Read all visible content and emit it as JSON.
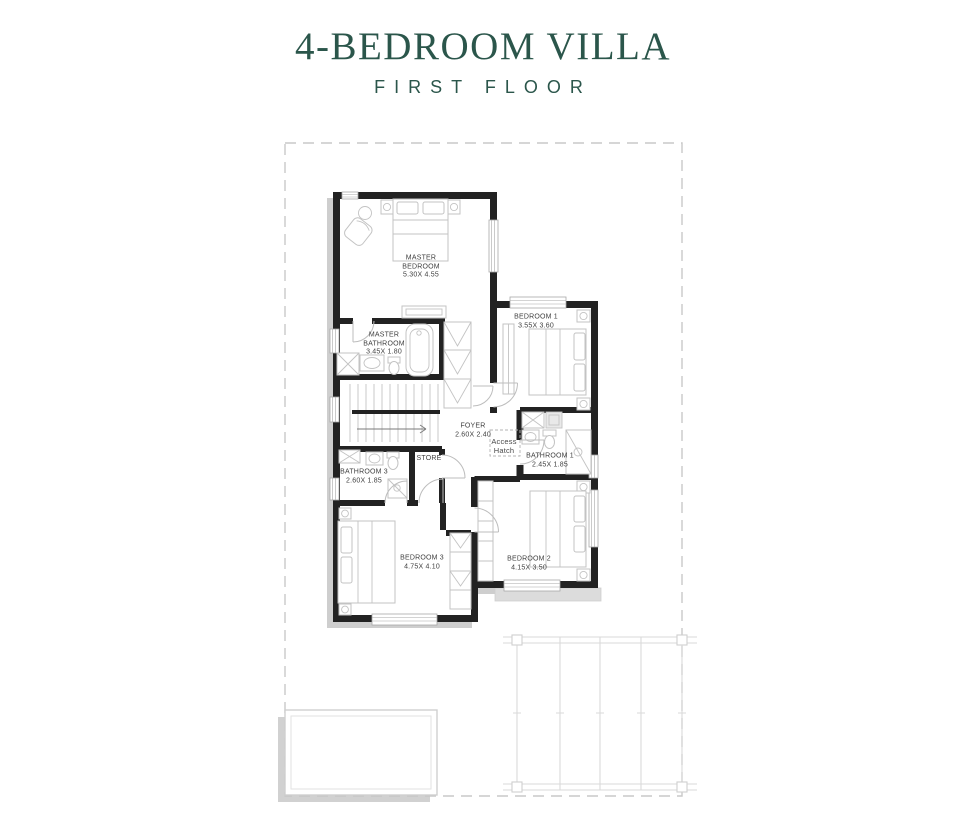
{
  "header": {
    "title": "4-BEDROOM VILLA",
    "subtitle": "FIRST FLOOR"
  },
  "rooms": [
    {
      "id": "master-bedroom",
      "lines": [
        "MASTER",
        "BEDROOM"
      ],
      "dims": "5.30X 4.55"
    },
    {
      "id": "master-bathroom",
      "lines": [
        "MASTER",
        "BATHROOM"
      ],
      "dims": "3.45X 1.80"
    },
    {
      "id": "bedroom-1",
      "lines": [
        "BEDROOM 1"
      ],
      "dims": "3.55X 3.60"
    },
    {
      "id": "foyer",
      "lines": [
        "FOYER"
      ],
      "dims": "2.60X 2.40"
    },
    {
      "id": "access-hatch",
      "lines": [
        "Access",
        "Hatch"
      ],
      "dims": ""
    },
    {
      "id": "bathroom-1",
      "lines": [
        "BATHROOM 1"
      ],
      "dims": "2.45X 1.85"
    },
    {
      "id": "store",
      "lines": [
        "STORE"
      ],
      "dims": ""
    },
    {
      "id": "bathroom-3",
      "lines": [
        "BATHROOM 3"
      ],
      "dims": "2.60X 1.85"
    },
    {
      "id": "bedroom-3",
      "lines": [
        "BEDROOM 3"
      ],
      "dims": "4.75X 4.10"
    },
    {
      "id": "bedroom-2",
      "lines": [
        "BEDROOM 2"
      ],
      "dims": "4.15X 3.50"
    }
  ],
  "colors": {
    "accent": "#2b564b",
    "walls": "#222222",
    "furniture_line": "#c3c3c3",
    "label_text": "#3f3f3f",
    "site_line": "#dadada",
    "boundary_dash": "#c9c9c9",
    "shadow": "#c6c6c6"
  }
}
